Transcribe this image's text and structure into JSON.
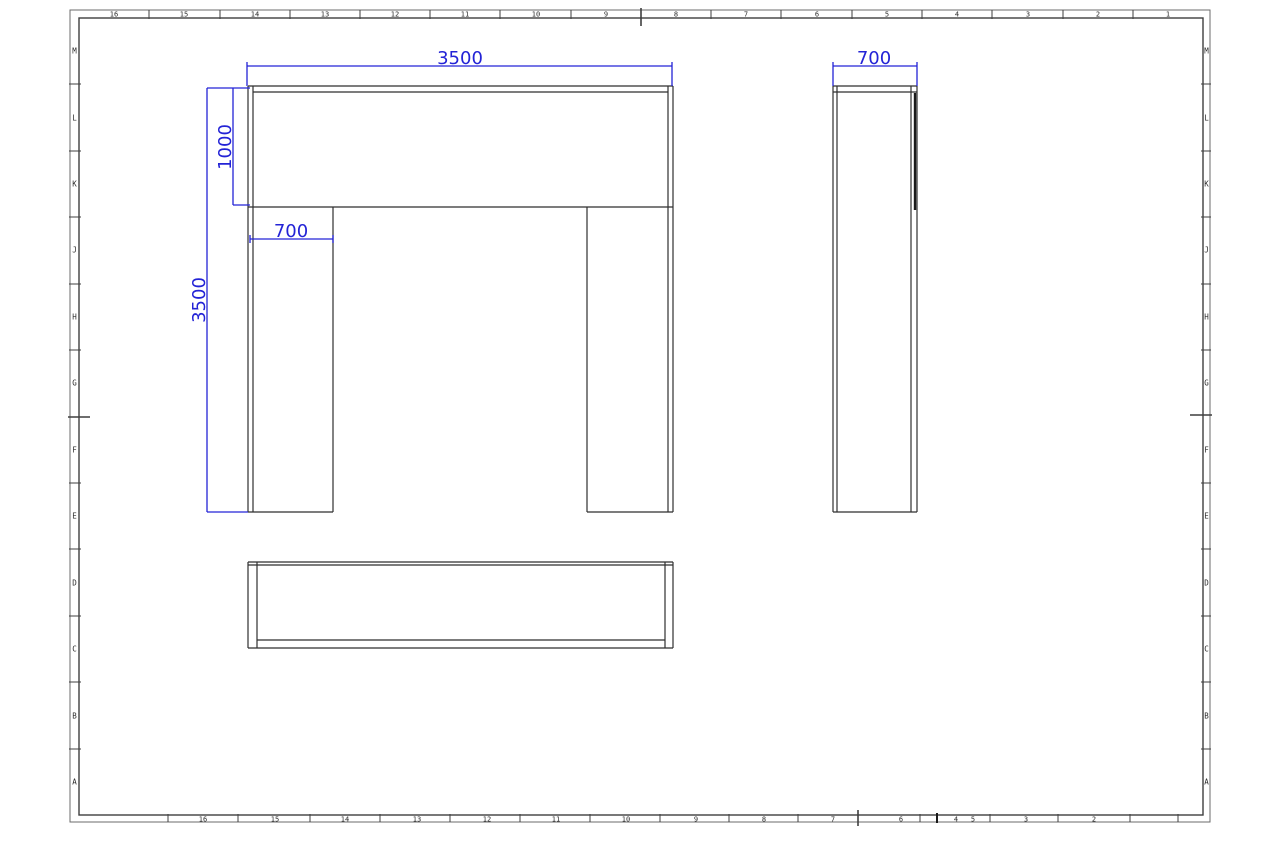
{
  "colors": {
    "background": "#ffffff",
    "geometry_line": "#2f2f2f",
    "geometry_thick": "#1a1a1a",
    "frame_outer": "#6b6b6b",
    "frame_inner": "#3f3f3f",
    "zone_text": "#2b2b2b",
    "dimension": "#2323d6"
  },
  "sheet": {
    "outer": [
      70,
      10,
      1210,
      822
    ],
    "inner": [
      79,
      18,
      1203,
      815
    ],
    "zones": {
      "top": {
        "band": [
          10,
          18
        ],
        "label_y": 16.5,
        "labels": [
          [
            "16",
            114
          ],
          [
            "15",
            184
          ],
          [
            "14",
            255
          ],
          [
            "13",
            325
          ],
          [
            "12",
            395
          ],
          [
            "11",
            465
          ],
          [
            "10",
            536
          ],
          [
            "9",
            606
          ],
          [
            "8",
            676
          ],
          [
            "7",
            746
          ],
          [
            "6",
            817
          ],
          [
            "5",
            887
          ],
          [
            "4",
            957
          ],
          [
            "3",
            1028
          ],
          [
            "2",
            1098
          ],
          [
            "1",
            1168
          ]
        ],
        "ticks": [
          149,
          220,
          290,
          360,
          430,
          500,
          571,
          641,
          711,
          781,
          852,
          922,
          992,
          1063,
          1133
        ],
        "center_tick": 641
      },
      "bottom": {
        "band": [
          815,
          822
        ],
        "label_y": 821.5,
        "labels": [
          [
            "16",
            203
          ],
          [
            "15",
            275
          ],
          [
            "14",
            345
          ],
          [
            "13",
            417
          ],
          [
            "12",
            487
          ],
          [
            "11",
            556
          ],
          [
            "10",
            626
          ],
          [
            "9",
            696
          ],
          [
            "8",
            764
          ],
          [
            "7",
            833
          ],
          [
            "6",
            901
          ],
          [
            "4",
            956
          ],
          [
            "5",
            973
          ],
          [
            "3",
            1026
          ],
          [
            "2",
            1094
          ]
        ],
        "ticks": [
          168,
          238,
          310,
          380,
          450,
          520,
          590,
          660,
          729,
          798,
          920,
          990,
          1058,
          1130,
          1178
        ],
        "bold_ticks": [
          937
        ],
        "center_tick": 858
      },
      "left": {
        "band": [
          70,
          79
        ],
        "label_x": 74.5,
        "labels": [
          [
            "M",
            51
          ],
          [
            "L",
            118
          ],
          [
            "K",
            184
          ],
          [
            "J",
            250
          ],
          [
            "H",
            317
          ],
          [
            "G",
            383
          ],
          [
            "F",
            450
          ],
          [
            "E",
            516
          ],
          [
            "D",
            583
          ],
          [
            "C",
            649
          ],
          [
            "B",
            716
          ],
          [
            "A",
            782
          ]
        ],
        "ticks": [
          84,
          151,
          217,
          284,
          350,
          483,
          549,
          616,
          682,
          749
        ],
        "center_tick": 417
      },
      "right": {
        "band": [
          1203,
          1210
        ],
        "label_x": 1206.5,
        "labels": [
          [
            "M",
            51
          ],
          [
            "L",
            118
          ],
          [
            "K",
            184
          ],
          [
            "J",
            250
          ],
          [
            "H",
            317
          ],
          [
            "G",
            383
          ],
          [
            "F",
            450
          ],
          [
            "E",
            516
          ],
          [
            "D",
            583
          ],
          [
            "C",
            649
          ],
          [
            "B",
            716
          ],
          [
            "A",
            782
          ]
        ],
        "ticks": [
          84,
          151,
          217,
          284,
          350,
          483,
          549,
          616,
          682,
          749
        ],
        "center_tick": 415
      }
    }
  },
  "views": {
    "front": {
      "name": "front-view-portal-frame",
      "lines": [
        [
          248,
          86,
          673,
          86
        ],
        [
          253,
          92,
          668,
          92
        ],
        [
          248,
          86,
          248,
          512
        ],
        [
          253,
          86,
          253,
          512
        ],
        [
          668,
          86,
          668,
          512
        ],
        [
          673,
          86,
          673,
          512
        ],
        [
          248,
          207,
          673,
          207
        ],
        [
          333,
          207,
          333,
          512
        ],
        [
          587,
          207,
          587,
          512
        ],
        [
          248,
          512,
          333,
          512
        ],
        [
          587,
          512,
          673,
          512
        ]
      ]
    },
    "side": {
      "name": "side-view-column",
      "lines": [
        [
          833,
          86,
          917,
          86
        ],
        [
          833,
          92,
          917,
          92
        ],
        [
          833,
          86,
          833,
          512
        ],
        [
          837,
          86,
          837,
          512
        ],
        [
          911,
          86,
          911,
          512
        ],
        [
          917,
          86,
          917,
          512
        ],
        [
          833,
          512,
          917,
          512
        ]
      ],
      "thick_lines": [
        [
          915,
          93,
          915,
          210
        ]
      ]
    },
    "plan": {
      "name": "plan-view-beam",
      "lines": [
        [
          248,
          562,
          673,
          562
        ],
        [
          248,
          565,
          673,
          565
        ],
        [
          248,
          562,
          248,
          648
        ],
        [
          257,
          562,
          257,
          648
        ],
        [
          665,
          562,
          665,
          648
        ],
        [
          673,
          562,
          673,
          648
        ],
        [
          248,
          648,
          673,
          648
        ],
        [
          257,
          640,
          665,
          640
        ]
      ]
    }
  },
  "dimensions": [
    {
      "id": "front-overall-width",
      "value": "3500",
      "rot": 0,
      "tx": 460,
      "ty": 64,
      "line": [
        247,
        66,
        672,
        66
      ],
      "aux": [
        [
          247,
          62,
          247,
          86
        ],
        [
          672,
          62,
          672,
          86
        ]
      ]
    },
    {
      "id": "front-beam-height",
      "value": "1000",
      "rot": -90,
      "tx": 231,
      "ty": 147,
      "line": [
        233,
        88,
        233,
        205
      ],
      "aux": [
        [
          207,
          88,
          250,
          88
        ],
        [
          233,
          205,
          250,
          205
        ]
      ]
    },
    {
      "id": "front-overall-height",
      "value": "3500",
      "rot": -90,
      "tx": 205,
      "ty": 300,
      "line": [
        207,
        88,
        207,
        512
      ],
      "aux": [
        [
          207,
          512,
          248,
          512
        ]
      ]
    },
    {
      "id": "front-leg-width",
      "value": "700",
      "rot": 0,
      "tx": 291,
      "ty": 237,
      "line": [
        250,
        239,
        333,
        239
      ],
      "aux": [
        [
          250,
          235,
          250,
          243
        ],
        [
          333,
          235,
          333,
          243
        ]
      ]
    },
    {
      "id": "side-width",
      "value": "700",
      "rot": 0,
      "tx": 874,
      "ty": 64,
      "line": [
        833,
        66,
        917,
        66
      ],
      "aux": [
        [
          833,
          62,
          833,
          86
        ],
        [
          917,
          62,
          917,
          86
        ]
      ]
    }
  ],
  "style": {
    "dim_font_size": 18,
    "ruler_font_size": 7,
    "zone_letter_font_size": 7.5
  }
}
